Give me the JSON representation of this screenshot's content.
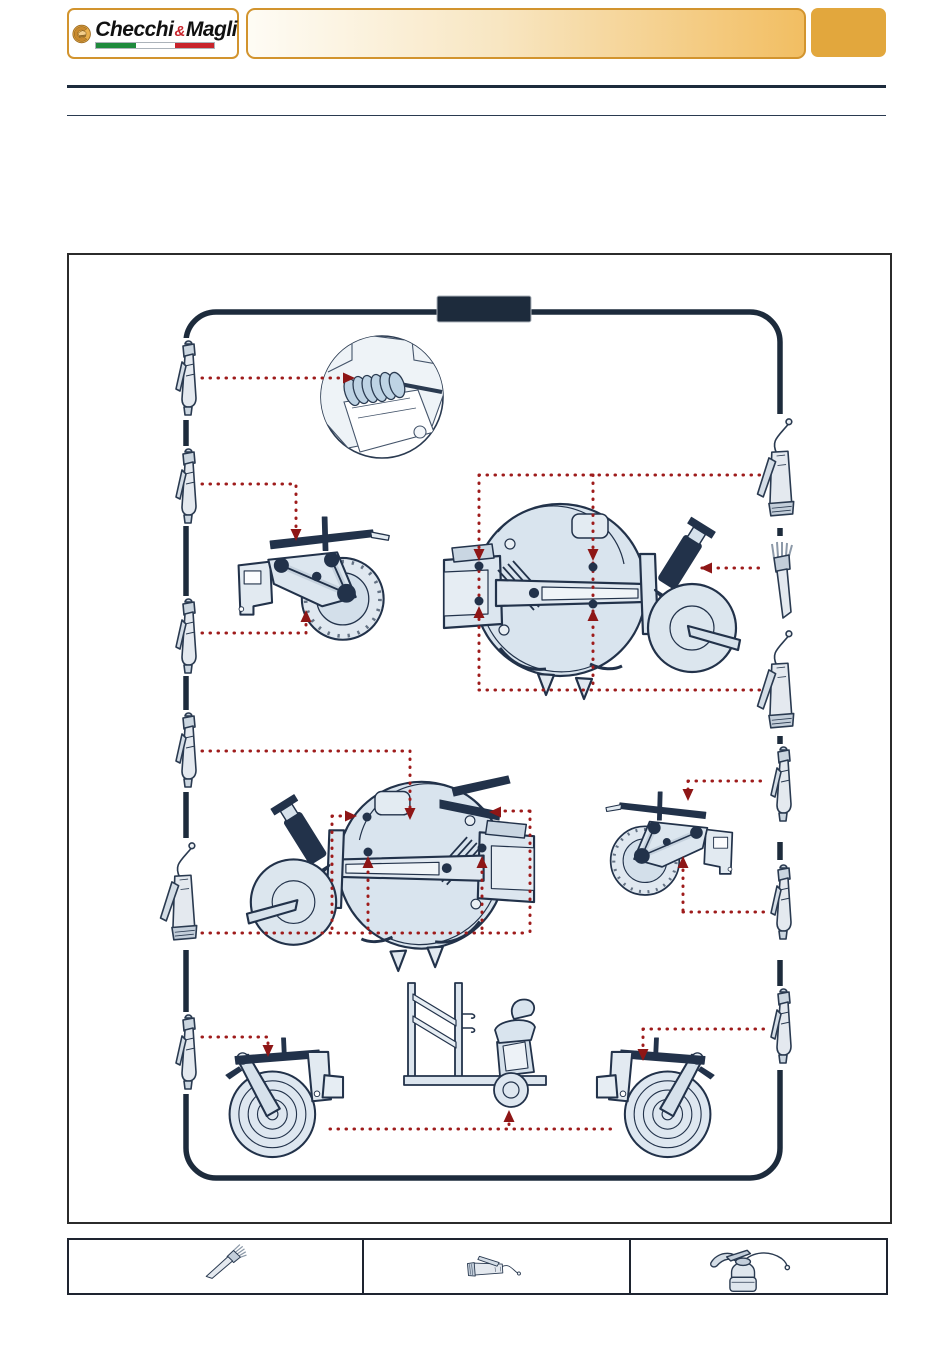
{
  "page": {
    "type": "maintenance-manual-page",
    "background": "#FFFFFF"
  },
  "header": {
    "logo": {
      "brand_first": "Checchi",
      "brand_amp": "&",
      "brand_second": "Magli",
      "flag_colors": [
        "#1F8A3D",
        "#FFFFFF",
        "#C8242C"
      ]
    },
    "banner_text": "",
    "page_tab_text": ""
  },
  "diagram": {
    "title_box_text": "",
    "frame_color": "#1D2B3C",
    "pointer_color": "#9E1B1B",
    "machine_fill": "#D9E4EE",
    "tools_left": [
      {
        "name": "grease-pump"
      },
      {
        "name": "grease-pump"
      },
      {
        "name": "grease-pump"
      },
      {
        "name": "grease-pump"
      },
      {
        "name": "grease-gun-hose"
      },
      {
        "name": "grease-pump"
      }
    ],
    "tools_right": [
      {
        "name": "grease-gun-hose"
      },
      {
        "name": "brush"
      },
      {
        "name": "grease-gun-hose"
      },
      {
        "name": "grease-pump"
      },
      {
        "name": "grease-pump"
      },
      {
        "name": "grease-pump"
      }
    ],
    "views": [
      "spring-greasing-detail",
      "press-wheel-unit-side",
      "planter-top-view",
      "planter-top-view-mirrored",
      "press-wheel-unit-side-mirrored",
      "packer-wheel-unit",
      "seat-trolley-unit",
      "packer-wheel-unit-mirrored"
    ]
  },
  "legend": {
    "items": [
      {
        "icon": "brush"
      },
      {
        "icon": "grease-gun"
      },
      {
        "icon": "oil-can"
      }
    ]
  },
  "colors": {
    "accent_gold": "#E2A73D",
    "accent_gold_border": "#D2942E",
    "banner_gradient_start": "#FEFCF5",
    "banner_gradient_end": "#F2BE62",
    "navy": "#1D2B3C",
    "red": "#9E1B1B"
  }
}
